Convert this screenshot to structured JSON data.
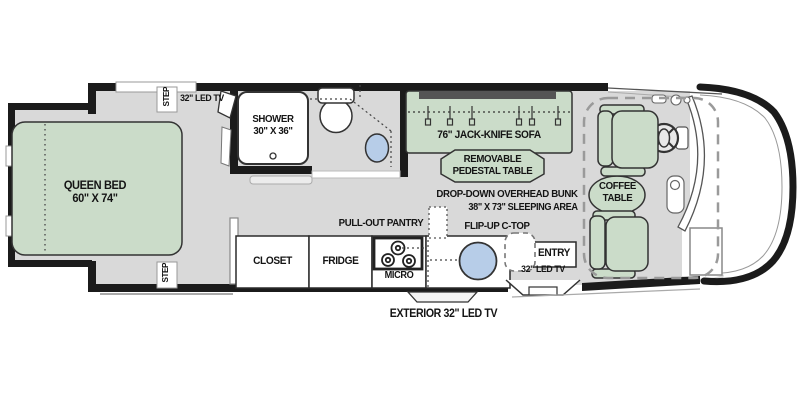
{
  "title": "Motorhome floor plan",
  "colors": {
    "furniture_green": "#cbdcc9",
    "floor_gray": "#d9d9d9",
    "wall_black": "#1b1b1b",
    "sink_blue": "#b7cde8",
    "sofa_band_gray": "#555555",
    "white": "#ffffff"
  },
  "labels": {
    "queen_bed_name": "QUEEN BED",
    "queen_bed_size": "60\" X 74\"",
    "step_top": "STEP",
    "step_bottom": "STEP",
    "bedroom_tv": "32\" LED TV",
    "shower_name": "SHOWER",
    "shower_size": "30\" X 36\"",
    "sofa": "76\" JACK-KNIFE SOFA",
    "pedestal_line1": "REMOVABLE",
    "pedestal_line2": "PEDESTAL TABLE",
    "bunk_line1": "DROP-DOWN OVERHEAD BUNK",
    "bunk_line2": "38\" X 73\" SLEEPING AREA",
    "pantry": "PULL-OUT PANTRY",
    "flip_up_ctop": "FLIP-UP C-TOP",
    "closet": "CLOSET",
    "fridge": "FRIDGE",
    "micro": "MICRO",
    "entry": "ENTRY",
    "entry_tv": "32\" LED TV",
    "coffee_line1": "COFFEE",
    "coffee_line2": "TABLE",
    "exterior_tv": "EXTERIOR 32\" LED TV"
  }
}
